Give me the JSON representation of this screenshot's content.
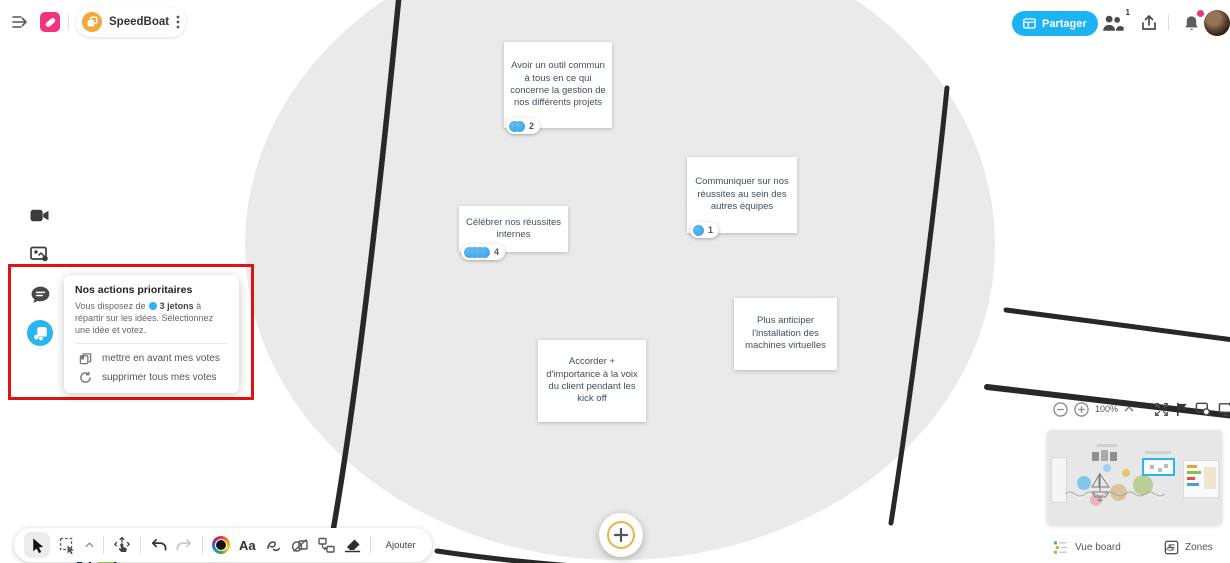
{
  "header": {
    "board_name": "SpeedBoat",
    "share_label": "Partager",
    "participants_badge": "1"
  },
  "voting_panel": {
    "title": "Nos actions prioritaires",
    "instructions_prefix": "Vous disposez de",
    "tokens_label": "3 jetons",
    "instructions_suffix": " à répartir sur les idées. Sélectionnez une idée et votez.",
    "action_promote": "mettre en avant mes votes",
    "action_clear": "supprimer tous mes votes"
  },
  "notes": [
    {
      "text": "Avoir un outil commun à tous en ce qui concerne la gestion de nos différents projets",
      "votes": 2
    },
    {
      "text": "Communiquer sur nos réussites au sein des autres équipes",
      "votes": 1
    },
    {
      "text": "Célébrer nos réussites internes",
      "votes": 4
    },
    {
      "text": "Plus anticiper l'installation des machines virtuelles",
      "votes": 0
    },
    {
      "text": "Accorder + d'importance à la voix du client pendant les kick off",
      "votes": 0
    }
  ],
  "toolbar": {
    "text_tool_label": "Aa",
    "add_label": "Ajouter"
  },
  "zoom_controls": {
    "zoom_level": "100%"
  },
  "bottom_bar": {
    "view_label": "Vue board",
    "zones_label": "Zones"
  },
  "icons": [
    "collapse-sidebar-icon",
    "klaxoon-logo",
    "board-icon",
    "kebab-menu-icon",
    "share-board-icon",
    "participants-icon",
    "export-icon",
    "bell-icon",
    "camera-icon",
    "media-icon",
    "chat-icon",
    "vote-tool-icon",
    "promote-votes-icon",
    "clear-votes-icon",
    "cursor-icon",
    "marquee-select-icon",
    "chevron-up-icon",
    "pan-icon",
    "undo-icon",
    "redo-icon",
    "color-wheel-icon",
    "text-tool-icon",
    "pen-icon",
    "shapes-icon",
    "connector-icon",
    "eraser-icon",
    "plus-icon",
    "zoom-out-icon",
    "zoom-in-icon",
    "fullscreen-icon",
    "flag-icon",
    "board-search-icon",
    "display-settings-icon",
    "view-board-icon",
    "zones-icon"
  ],
  "colors": {
    "accent_blue": "#1db3f2",
    "vote_token_blue": "#2f9fe4",
    "annotation_red": "#e11212",
    "brand_pink": "#f2337e",
    "brand_orange": "#f2a93b",
    "fab_ring_gold": "#edb33f",
    "canvas_circle_gray": "#eaeaea"
  }
}
